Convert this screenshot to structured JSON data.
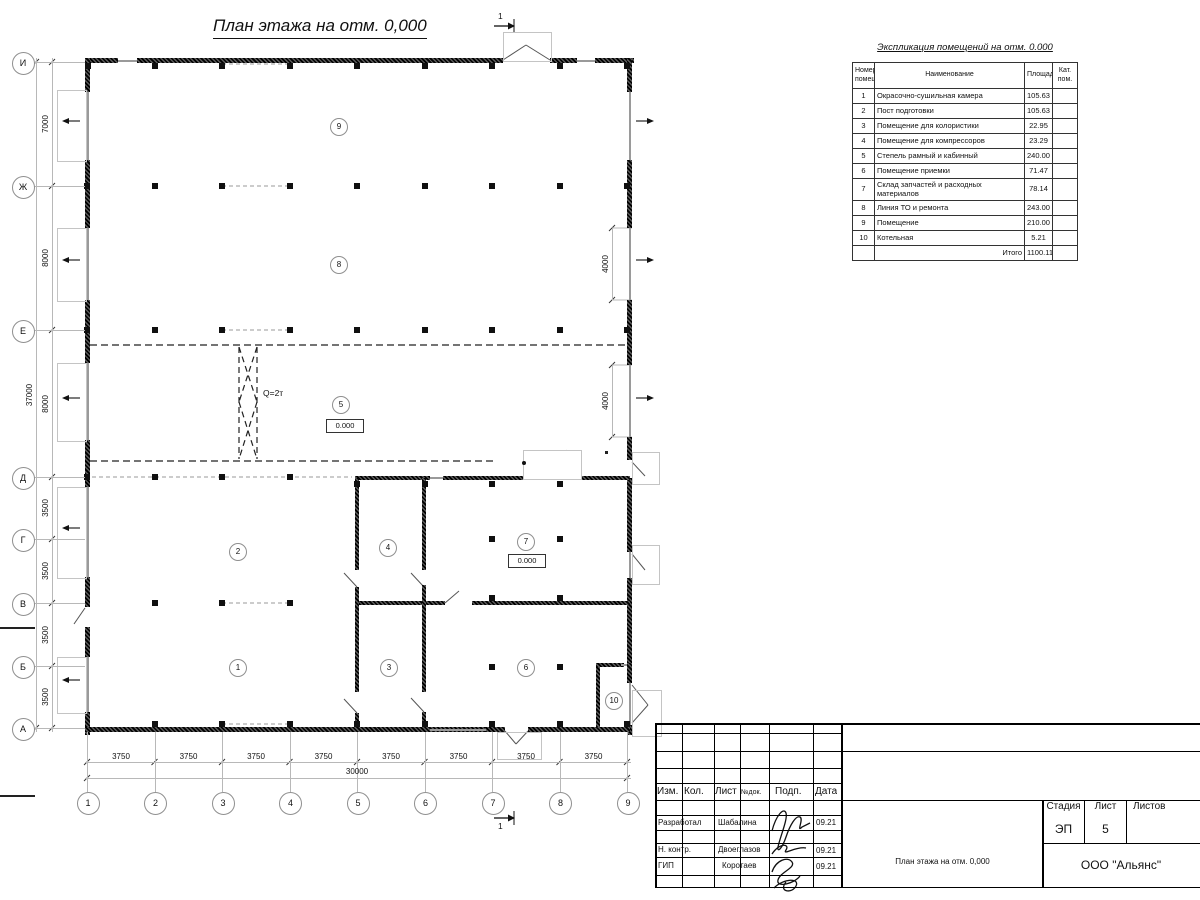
{
  "plan": {
    "title": "План этажа на отм. 0,000",
    "grid_rows": [
      "И",
      "Ж",
      "Е",
      "Д",
      "Г",
      "В",
      "Б",
      "А"
    ],
    "grid_cols": [
      "1",
      "2",
      "3",
      "4",
      "5",
      "6",
      "7",
      "8",
      "9"
    ],
    "rooms": [
      "1",
      "2",
      "3",
      "4",
      "5",
      "6",
      "7",
      "8",
      "9",
      "10"
    ],
    "crane_label": "Q=2т",
    "level_marks": [
      "0.000",
      "0.000"
    ],
    "section_mark": "1"
  },
  "dimensions": {
    "left_segments": [
      "7000",
      "8000",
      "8000",
      "3500",
      "3500",
      "3500",
      "3500"
    ],
    "left_total": "37000",
    "bottom_segments": [
      "3750",
      "3750",
      "3750",
      "3750",
      "3750",
      "3750",
      "3750",
      "3750"
    ],
    "bottom_total": "30000",
    "right_gate_widths": [
      "4000",
      "4000"
    ]
  },
  "spec_table": {
    "title": "Экспликация помещений на отм. 0.000",
    "headers": [
      "Номер помещ.",
      "Наименование",
      "Площадь",
      "Кат. пом."
    ],
    "rows": [
      [
        "1",
        "Окрасочно-сушильная камера",
        "105.63"
      ],
      [
        "2",
        "Пост подготовки",
        "105.63"
      ],
      [
        "3",
        "Помещение для колористики",
        "22.95"
      ],
      [
        "4",
        "Помещение для компрессоров",
        "23.29"
      ],
      [
        "5",
        "Степель рамный и кабинный",
        "240.00"
      ],
      [
        "6",
        "Помещение приемки",
        "71.47"
      ],
      [
        "7",
        "Склад запчастей и расходных материалов",
        "78.14"
      ],
      [
        "8",
        "Линия ТО и ремонта",
        "243.00"
      ],
      [
        "9",
        "Помещение",
        "210.00"
      ],
      [
        "10",
        "Котельная",
        "5.21"
      ]
    ],
    "total_label": "Итого",
    "total_value": "1100.11"
  },
  "title_block": {
    "rev_headers": [
      "Изм.",
      "Кол.",
      "Лист",
      "№док.",
      "Подп.",
      "Дата"
    ],
    "signature_rows": [
      {
        "role": "Разработал",
        "name": "Шабалина",
        "date": "09.21"
      },
      {
        "role": "Н. контр.",
        "name": "Двоеглазов",
        "date": "09.21"
      },
      {
        "role": "ГИП",
        "name": "Коротаев",
        "date": "09.21"
      }
    ],
    "stage_label": "Стадия",
    "sheet_label": "Лист",
    "sheets_label": "Листов",
    "stage_value": "ЭП",
    "sheet_value": "5",
    "doc_title": "План этажа на отм. 0,000",
    "company": "ООО \"Альянс\""
  }
}
